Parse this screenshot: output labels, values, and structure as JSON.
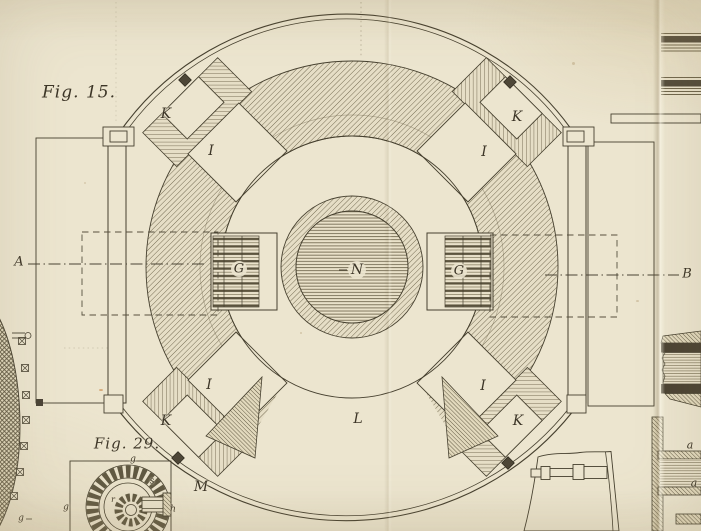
{
  "plate": {
    "title": "Fig. 15.",
    "inset_title": "Fig. 29.",
    "colors": {
      "paper": "#ece5cf",
      "ink": "#46402f",
      "hatch": "#6b6249",
      "dense_hatch": "#574f3a"
    }
  },
  "labels": [
    {
      "name": "label-k-top-left",
      "text": "K",
      "x": 166,
      "y": 114,
      "size": 14
    },
    {
      "name": "label-i-top-left",
      "text": "I",
      "x": 211,
      "y": 151,
      "size": 14
    },
    {
      "name": "label-k-top-right",
      "text": "K",
      "x": 517,
      "y": 117,
      "size": 14
    },
    {
      "name": "label-i-top-right",
      "text": "I",
      "x": 484,
      "y": 152,
      "size": 14
    },
    {
      "name": "label-g-left",
      "text": "G",
      "x": 239,
      "y": 269,
      "size": 13
    },
    {
      "name": "label-n-core",
      "text": "N",
      "x": 357,
      "y": 270,
      "size": 14
    },
    {
      "name": "label-g-right",
      "text": "G",
      "x": 459,
      "y": 271,
      "size": 13
    },
    {
      "name": "label-i-bottom-left",
      "text": "I",
      "x": 209,
      "y": 385,
      "size": 14
    },
    {
      "name": "label-k-bottom-left",
      "text": "K",
      "x": 166,
      "y": 421,
      "size": 14
    },
    {
      "name": "label-i-bottom-right",
      "text": "I",
      "x": 483,
      "y": 386,
      "size": 14
    },
    {
      "name": "label-k-bottom-right",
      "text": "K",
      "x": 518,
      "y": 421,
      "size": 14
    },
    {
      "name": "label-l",
      "text": "L",
      "x": 358,
      "y": 419,
      "size": 14
    },
    {
      "name": "label-m",
      "text": "M",
      "x": 201,
      "y": 487,
      "size": 14
    },
    {
      "name": "label-a-axis-left",
      "text": "A",
      "x": 19,
      "y": 262,
      "size": 13
    },
    {
      "name": "label-b-axis-right",
      "text": "B",
      "x": 687,
      "y": 274,
      "size": 13
    },
    {
      "name": "label-a-shaft-upper",
      "text": "a",
      "x": 690,
      "y": 445,
      "size": 11
    },
    {
      "name": "label-a-shaft-lower",
      "text": "a",
      "x": 694,
      "y": 483,
      "size": 11
    },
    {
      "name": "inset-label-g-top",
      "text": "g",
      "x": 133,
      "y": 460,
      "size": 9
    },
    {
      "name": "inset-label-s",
      "text": "s",
      "x": 152,
      "y": 482,
      "size": 9
    },
    {
      "name": "inset-label-g-left",
      "text": "g",
      "x": 66,
      "y": 508,
      "size": 9
    },
    {
      "name": "inset-label-h",
      "text": "h",
      "x": 173,
      "y": 510,
      "size": 9
    },
    {
      "name": "inset-label-r",
      "text": "r",
      "x": 113,
      "y": 500,
      "size": 8
    },
    {
      "name": "wheel-label-g",
      "text": "g",
      "x": 21,
      "y": 519,
      "size": 9
    }
  ]
}
